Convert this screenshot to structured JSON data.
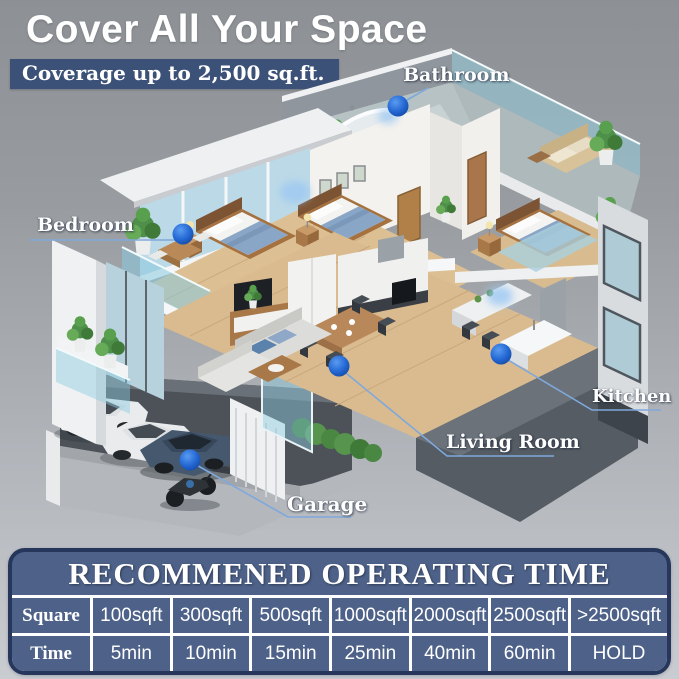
{
  "header": {
    "title": "Cover All Your Space",
    "badge": "Coverage up to 2,500 sq.ft."
  },
  "house_labels": [
    {
      "id": "bathroom",
      "text": "Bathroom"
    },
    {
      "id": "bedroom",
      "text": "Bedroom"
    },
    {
      "id": "kitchen",
      "text": "Kitchen"
    },
    {
      "id": "living_room",
      "text": "Living Room"
    },
    {
      "id": "garage",
      "text": "Garage"
    }
  ],
  "operating_table": {
    "title": "RECOMMENED OPERATING TIME",
    "row_headers": [
      "Square",
      "Time"
    ],
    "columns": [
      "100sqft",
      "300sqft",
      "500sqft",
      "1000sqft",
      "2000sqft",
      "2500sqft",
      ">2500sqft"
    ],
    "times": [
      "5min",
      "10min",
      "15min",
      "25min",
      "40min",
      "60min",
      "HOLD"
    ]
  },
  "colors": {
    "accent_blue": "#2468d4",
    "badge_bg": "#3c5177",
    "table_bg": "#4d6189",
    "table_border": "#27375c",
    "label_line": "#7fa8dc"
  }
}
